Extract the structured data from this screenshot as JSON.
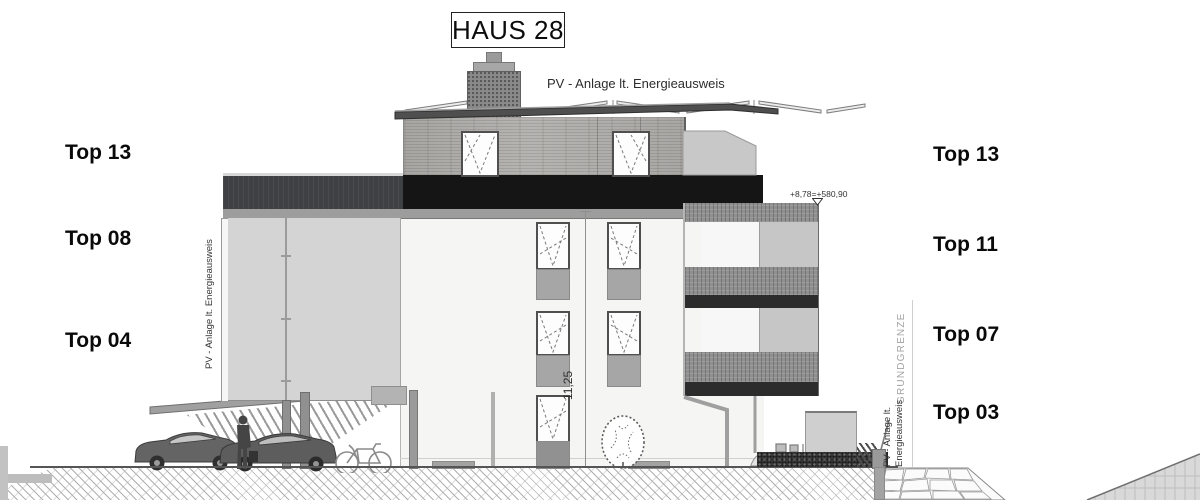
{
  "title": "HAUS 28",
  "roof_pv_label": "PV - Anlage lt. Energieausweis",
  "left_panel_label": "PV - Anlage lt. Energieausweis",
  "right_pv_label": {
    "line1": "PV - Anlage lt.",
    "line2": "Energieausweis"
  },
  "boundary_label": "GRUNDGRENZE",
  "dimension_label": "11,25",
  "level_label": "+8,78=+580,90",
  "units_left": [
    {
      "label": "Top 13"
    },
    {
      "label": "Top 08"
    },
    {
      "label": "Top 04"
    }
  ],
  "units_right": [
    {
      "label": "Top 13"
    },
    {
      "label": "Top 11"
    },
    {
      "label": "Top 07"
    },
    {
      "label": "Top 03"
    }
  ],
  "colors": {
    "slab_black": "#151515",
    "parapet_gray": "#3e4043",
    "pv_panel": "#d4d4d4",
    "railing": "#8f8f8f",
    "balcony_slab": "#2c2c2c",
    "facade": "#f5f5f4"
  }
}
